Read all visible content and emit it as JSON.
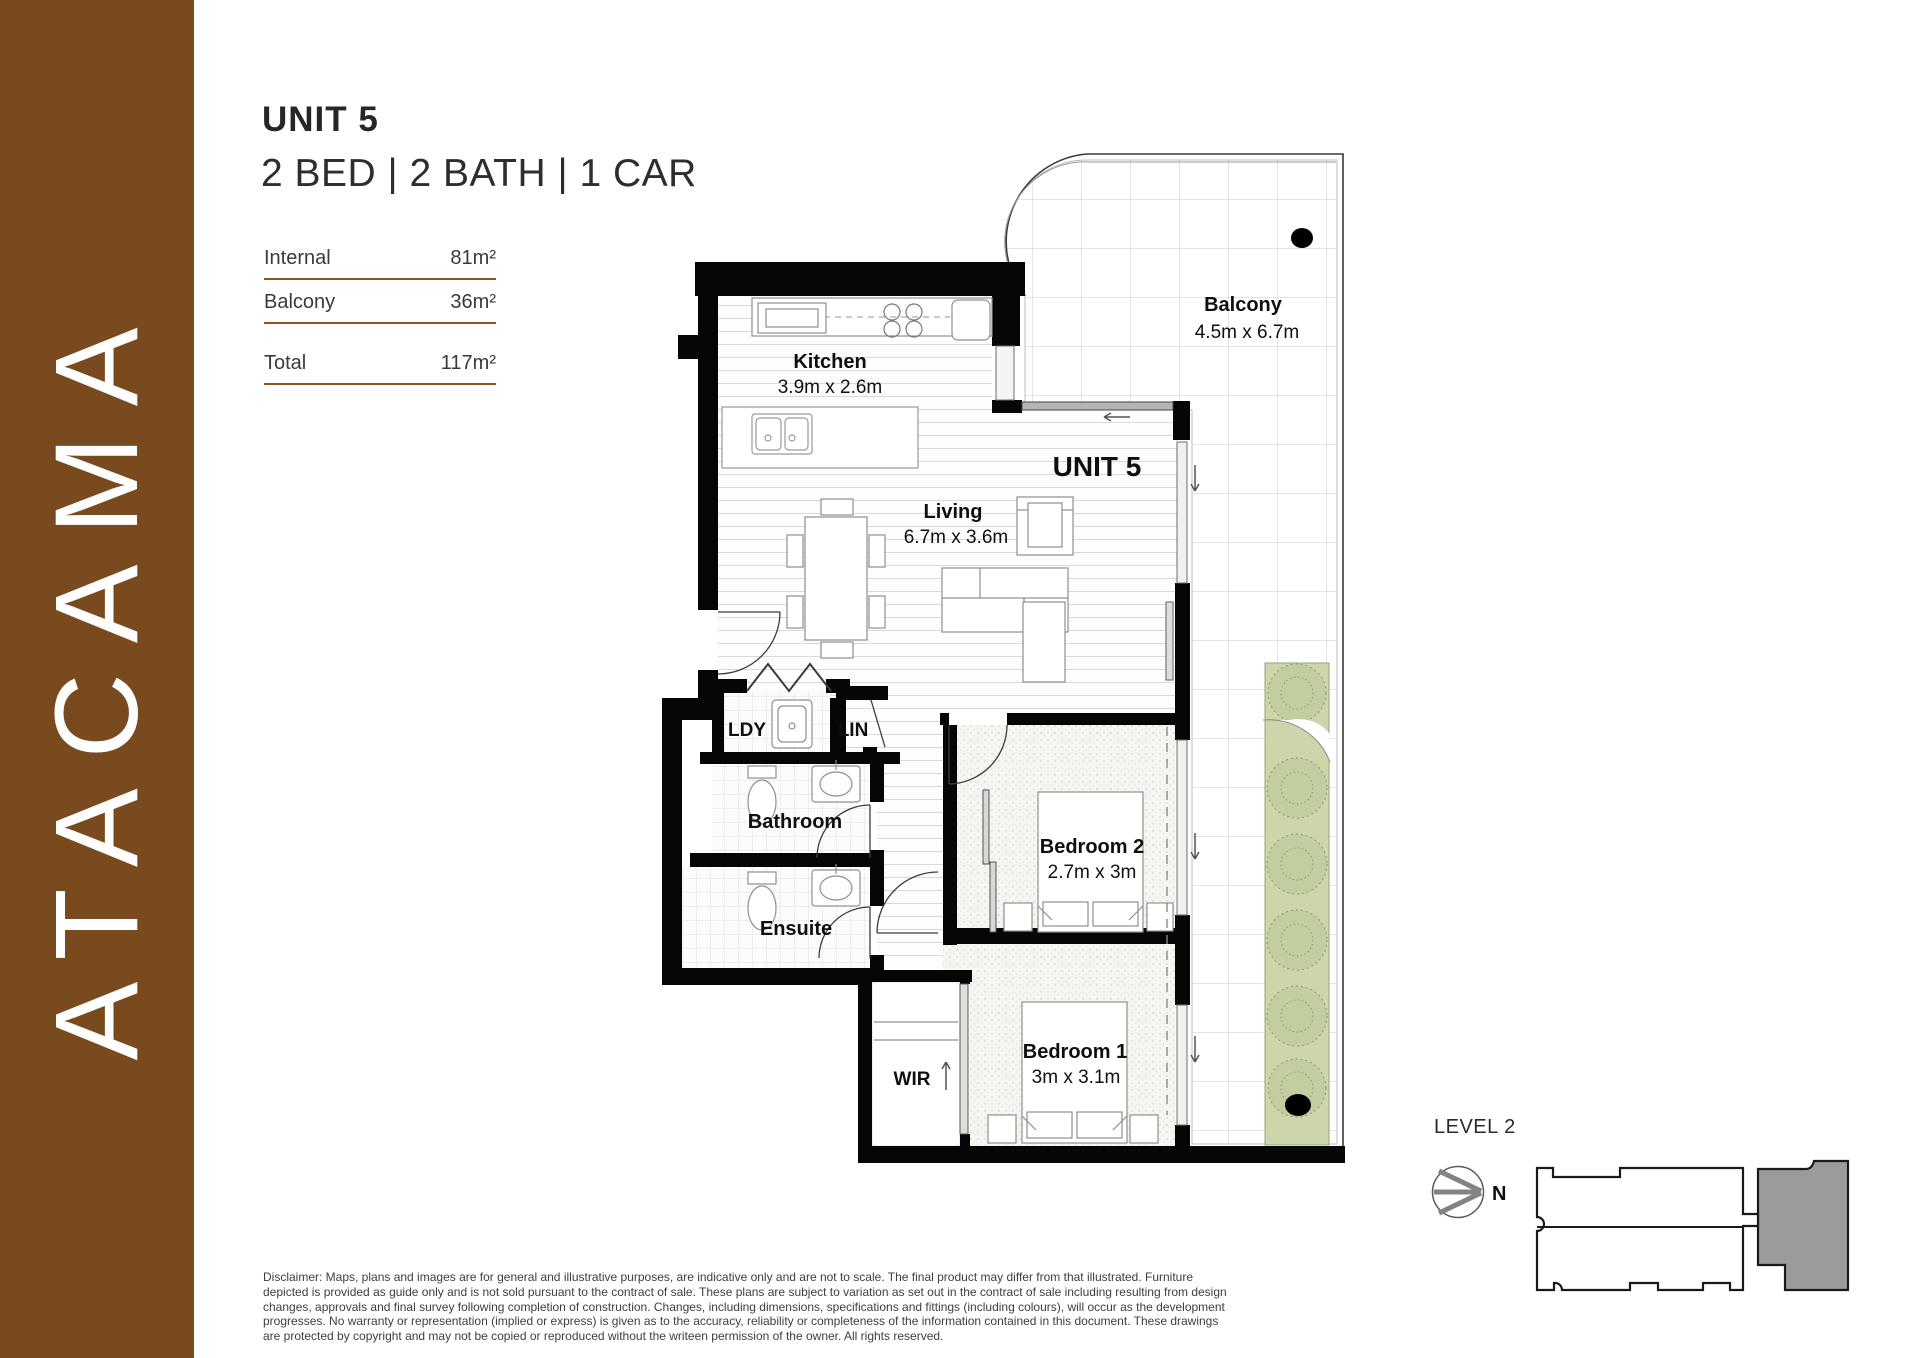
{
  "brand": {
    "name": "ATACAMA"
  },
  "header": {
    "title": "UNIT 5",
    "config": "2 BED | 2 BATH | 1 CAR"
  },
  "areas": {
    "internal_label": "Internal",
    "internal_value": "81m²",
    "balcony_label": "Balcony",
    "balcony_value": "36m²",
    "total_label": "Total",
    "total_value": "117m²"
  },
  "plan": {
    "unit_label": "UNIT 5",
    "balcony": {
      "name": "Balcony",
      "dims": "4.5m x 6.7m"
    },
    "kitchen": {
      "name": "Kitchen",
      "dims": "3.9m x 2.6m"
    },
    "living": {
      "name": "Living",
      "dims": "6.7m x 3.6m"
    },
    "ldy": {
      "name": "LDY"
    },
    "lin": {
      "name": "LIN"
    },
    "bathroom": {
      "name": "Bathroom"
    },
    "ensuite": {
      "name": "Ensuite"
    },
    "bedroom2": {
      "name": "Bedroom 2",
      "dims": "2.7m x 3m"
    },
    "bedroom1": {
      "name": "Bedroom 1",
      "dims": "3m x 3.1m"
    },
    "wir": {
      "name": "WIR"
    }
  },
  "keyplan": {
    "level": "LEVEL 2",
    "north": "N"
  },
  "colors": {
    "brand_brown": "#7a4a1f",
    "rule_brown": "#8c5322",
    "planter_green": "#cdd6ab",
    "keyplan_gray": "#9b9b9b"
  },
  "disclaimer": "Disclaimer: Maps, plans and images are for general and illustrative purposes, are indicative only and are not to scale. The final product may differ from that illustrated. Furniture depicted is provided as guide only and is not sold pursuant to the contract of sale. These plans are subject to variation as set out in the contract of sale including resulting from design changes, approvals and final survey following completion of construction. Changes, including dimensions, specifications and fittings (including colours), will occur as the development progresses. No warranty or representation (implied or express) is given as to the accuracy, reliability or completeness of the information contained in this document. These drawings are protected by copyright and may not be copied or reproduced without the writeen permission of the owner. All rights reserved."
}
